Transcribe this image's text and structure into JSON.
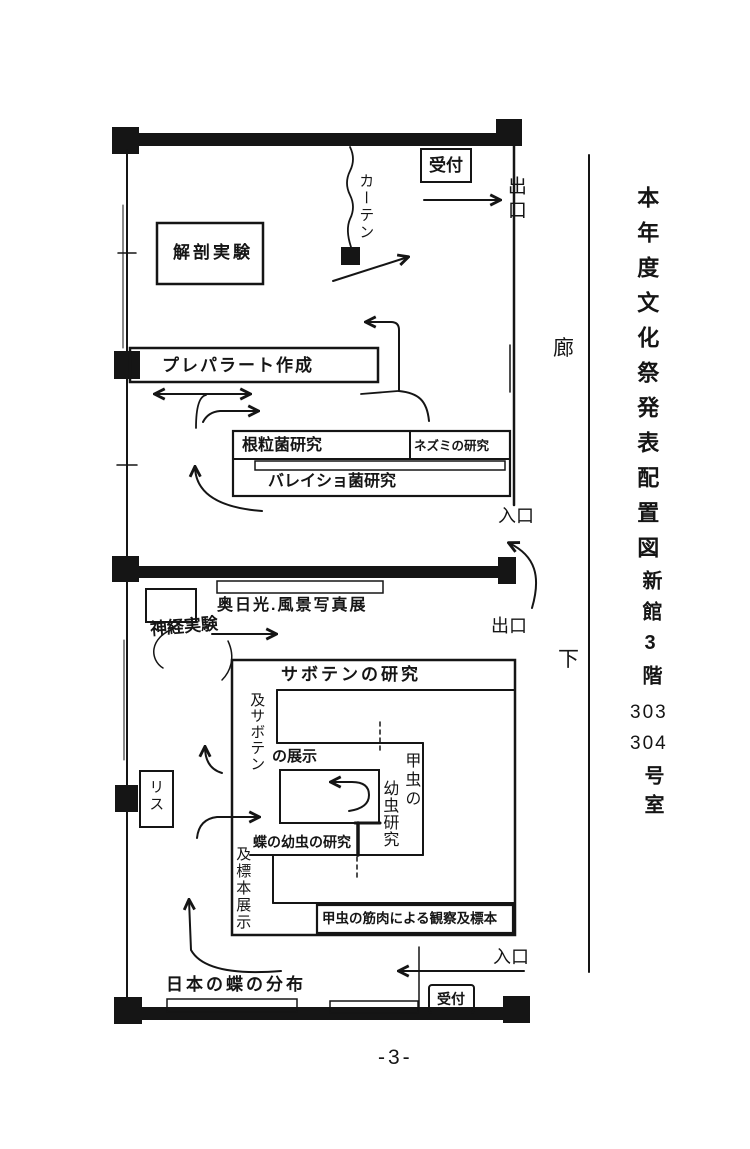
{
  "sidebar_title": {
    "main": "本年度文化祭発表配置図",
    "building": "新館3階",
    "room1": "303",
    "room2": "304",
    "room_suffix": "号室"
  },
  "corridor": {
    "top_char": "廊",
    "bottom_char": "下"
  },
  "top_room": {
    "reception": "受付",
    "exit": "出口",
    "curtain": "カーテン",
    "dissection": "解剖実験",
    "slide_prep": "プレパラート作成",
    "nodule_bacteria": "根粒菌研究",
    "mouse_research": "ネズミの研究",
    "potato_bacteria": "バレイショ菌研究",
    "entrance": "入口"
  },
  "middle_zone": {
    "photo_exhibition": "奥日光.風景写真展",
    "nerve_experiment": "神経実験",
    "exit": "出口"
  },
  "bottom_room": {
    "cactus_research": "サボテンの研究",
    "cactus_display_vertical": "及サボテン",
    "cactus_display_horizontal": "の展示",
    "beetle_larva_col_right": "甲虫の",
    "beetle_larva_col_left": "幼虫研究",
    "butterfly_larva": "蝶の幼虫の研究",
    "specimen_display": "及標本展示",
    "beetle_muscle_specimen": "甲虫の筋肉による観察及標本",
    "squirrel": "リス",
    "butterfly_distribution": "日本の蝶の分布",
    "reception": "受付",
    "entrance": "入口"
  },
  "footer": {
    "page_number": "-3-"
  }
}
